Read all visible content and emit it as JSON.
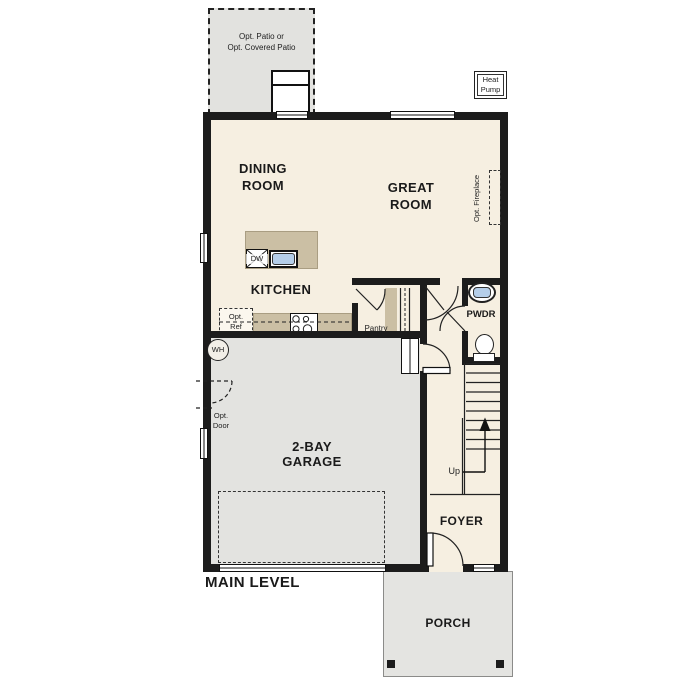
{
  "title": "MAIN LEVEL",
  "colors": {
    "floor": "#f6efe1",
    "garage": "#e3e3e0",
    "outdoor": "#e2e2df",
    "counter": "#cbbfa4",
    "fixture": "#b5cee9",
    "wall": "#1c1c1c"
  },
  "outdoor": {
    "patio": {
      "line1": "Opt. Patio or",
      "line2": "Opt. Covered Patio"
    },
    "heat_pump": {
      "line1": "Heat",
      "line2": "Pump"
    },
    "porch": {
      "label": "PORCH"
    }
  },
  "rooms": {
    "dining": {
      "line1": "DINING",
      "line2": "ROOM"
    },
    "great": {
      "line1": "GREAT",
      "line2": "ROOM"
    },
    "kitchen": {
      "label": "KITCHEN"
    },
    "garage": {
      "line1": "2-BAY",
      "line2": "GARAGE"
    },
    "foyer": {
      "label": "FOYER"
    },
    "pwdr": {
      "label": "PWDR"
    },
    "pantry": {
      "label": "Pantry"
    }
  },
  "annotations": {
    "opt_ref": {
      "line1": "Opt.",
      "line2": "Ref"
    },
    "opt_door": {
      "line1": "Opt.",
      "line2": "Door"
    },
    "opt_fireplace": {
      "label": "Opt. Fireplace"
    },
    "wh": {
      "label": "WH"
    },
    "dw": {
      "label": "DW"
    },
    "up": {
      "label": "Up"
    }
  }
}
